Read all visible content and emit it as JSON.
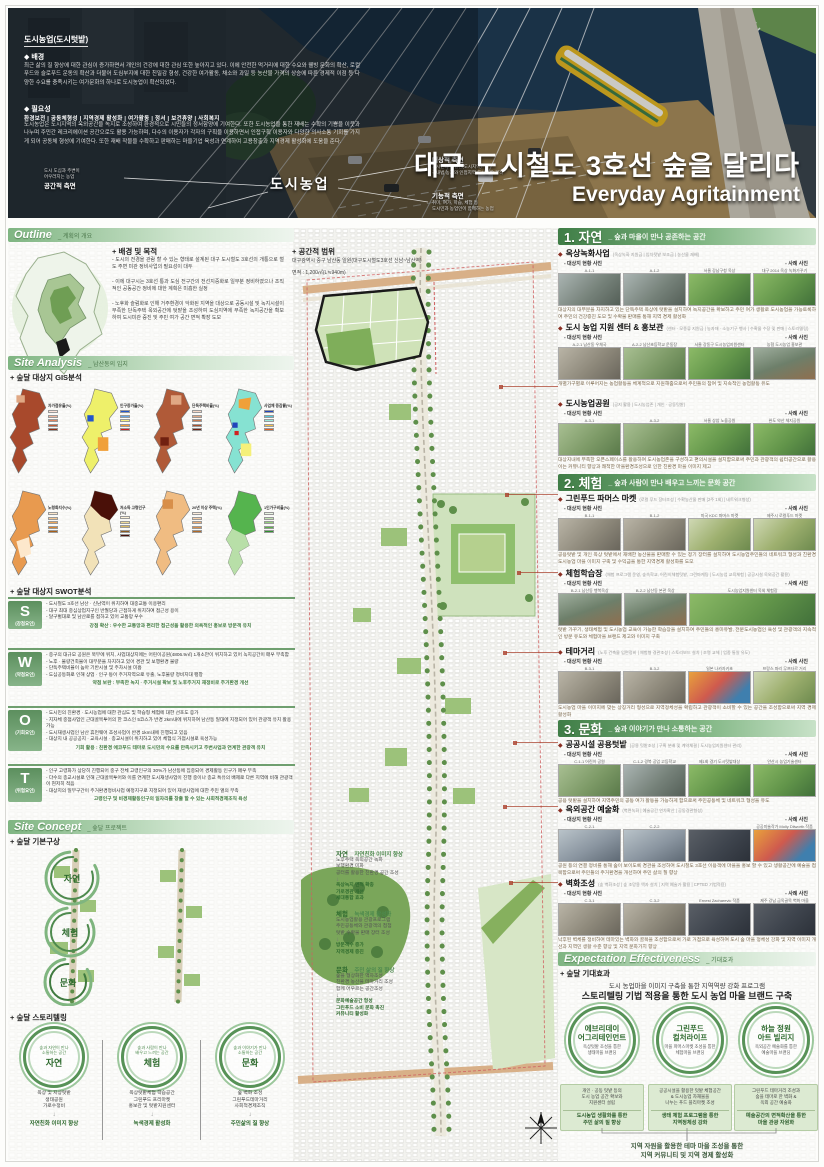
{
  "hero": {
    "topic": "도시농업(도시텃밭)",
    "bg_title": "◆ 배경",
    "bg_text": "최근 삶의 질 향상에 대한 관심이 증가하면서 개인의 건강에 대한 관심 또한 높아지고 있다. 이에 안전한 먹거리에 대한 수요와 웰빙 문화의 확산, 로컬푸드와 슬로푸드 운동의 확산과 더불어 도심부지에 대한 친밀감 형성, 건강한 여가활동, 채소와 과일 등 농산물 가격의 상승에 따른 경제적 이점 등 다양한 수요를 충족시키는 여가문화의 하나로 도시농업이 확산되었다.",
    "need_title": "◆ 필요성",
    "need_keywords": "환경보전  |  공동체형성  |  지역경제 활성화  |  여가활동  |  정서  |  보건휴양  |  사회복지",
    "need_text": "도시농업은 도시지역의 옥외공간을 녹지로 조성하여 환경적으로 시민들의 정서함양에 기여한다. 또한 도시농업을 통한 재배는 수확의 기쁨을 이웃과 나누며 주민간 레크리에이션 공간으로도 활용 가능하며, 다수의 이용자가 각자의 구획을 이용하면서 인접구획 이용자와 다양한 의사소통 기회를 가지게 되어 공동체 형성에 기여한다. 또한 재배 작물을 수확하고 판매하는 마을기업 육성과 연계하여 고용창출과 지역경제 활성화에 도움을 준다.",
    "diagram": {
      "center": "도시농업",
      "left_label": "공간적 측면",
      "left_text": "도시 도심과 주변이\n어우러지는 농업",
      "rt_label": "대상적 측면",
      "rt_text": "도시민과 농업인(도시지역)\n국내법 농지와 인접지역 도시텃밭 경작",
      "rb_label": "기능적 측면",
      "rb_text": "취미, 여가, 학습, 체험 등\n도시민과 농업인이 함께하는 농업"
    },
    "title": "대구 도시철도 3호선 숲을 달리다",
    "subtitle": "Everyday Agritainment"
  },
  "outline": {
    "header": "Outline",
    "header_sub": "_ 계획의 개요",
    "goal_title": "+ 배경 및 목적",
    "goal_text": "- 도시의 전경을 관람 할 수 있는 형태로 설계된 대구 도시철도 3호선의 개통으로 철도 주변 미관 정비사업의 필요성이 대두\n\n- 이에 대구시는 3호선 통과 도심 전구간의 전선지중화로 일부분 정비하였으나 조직적인 공동공간 정비에 대한 계획은 미흡한 실정\n\n- 노후화 슬럼화로 인해 거주환경이 악화된 지역을 대상으로 공동시설 및 녹지시설이 부족한 단독주택 옥외공간에 텃밭을 조성하여 도심지역에 부족한 녹지공간을 확보하여 도시미관 증진 및 주민 여가 공간 면적 확장 도모",
    "scope_title": "+ 공간적 범위",
    "scope_line1": "대구광역시 중구 남산동 일원(대구도시철도3호선 신남~남산역)",
    "scope_line2": "면적 : 1,200㎡(L≒940m)"
  },
  "analysis": {
    "header": "Site Analysis",
    "header_sub": "_ 남산동의 입지",
    "gis_title": "+ 숲달 대상지 GIS분석",
    "gis": [
      {
        "label": "자가점유율(%)"
      },
      {
        "label": "인구증가율(%)"
      },
      {
        "label": "단독주택비율(%)"
      },
      {
        "label": "사업체 증감률(%)"
      },
      {
        "label": "노령화지수(%)"
      },
      {
        "label": "저소득 고령인구(%)"
      },
      {
        "label": "20년 이상 주택(%)"
      },
      {
        "label": "1인가구비율(%)"
      }
    ],
    "swot_title": "+ 숲달 대상지 SWOT분석",
    "swot": [
      {
        "letter": "S",
        "name": "(강점요인)",
        "items": "- 도시철도 3호선 남산 · 신남역이 위치하여 대중교통 이용편리\n- 대구 최대 중심상업지구인 반월당과 근접하게 위치하여 접근성 용이\n- 달구벌대로 및 남산로를 접하고 있어 교통망 우수",
        "summary": "강점 확산 : 우수한 교통망과 편리한 접근성을 활용한 의욕적인 홍보로 방문객 유치"
      },
      {
        "letter": "W",
        "name": "(약점요인)",
        "items": "- 중구의 대규모 공원은 북부에 위치, 사업대상지에는 어린이공원(4806.9㎡) 1개소만이 위치하고 있어 녹지공간이 매우 부족함\n- 노후 · 불량건축물이 대부분을 차지하고 있어 경관 및 보행환경 불량\n- 단독주택비율이 높아 기반시설 및 주차시설 미흡\n- 도심공동화로 인해 상업 · 인구 등이 주거지역으로 유출, 노후불량 정비지대 팽창",
        "summary": "약점 보완 : 부족한 녹지 · 주거시설 확보 및 노후주거지 재정비로 주거환경 개선"
      },
      {
        "letter": "O",
        "name": "(기회요인)",
        "items": "- 도시민의 친환경 · 도시농업에 대한 관심도 및 학습형 체험에 대한 선호도 증가\n- 지자체 중점사업인 근대골목투어의 한 코스인 5코스가 반경 2km내에 위치하여 남산동 일대에 지정되어 있어 관광객 유치 활용가능\n- 도시재생사업인 남산 휴먼웨어 조성사업이 반경 1km내에 진행되고 있음\n- 대상지 내 공공공지 · 교육시설 · 종교시설이 위치하고 있어 체험식 거점시설로 육성가능",
        "summary": "기회 활용 : 친환경 에코푸드 테마로 도시민의 수요를 만족시키고 주변사업과 연계한 관광객 유치"
      },
      {
        "letter": "T",
        "name": "(위협요인)",
        "items": "- 인구 고령화가 상당히 진행되어 중구 전체 고령인구의 30%가 남산동에 집중되어 경제활동 인구가 매우 부족\n- 다수의 종교시설로 인해 근대골목투어와 이를 연계한 도시재생사업이 진행 중이나 종교 특유의 배제로 다른 지역에 비해 관광객이 현저히 적음\n- 대상지의 일부구간이 주거환경정비사업 예정지구로 지정되어 있어 재생사업에 대한 주민 열의 부족",
        "summary": "고령인구 및 비경제활동인구의 일자리를 창출 할 수 있는 사회적경제조직 육성"
      }
    ]
  },
  "concept": {
    "header": "Site Concept",
    "header_sub": "_ 숲달 프로젝트",
    "title": "+ 숲달 기본구상",
    "themes": [
      {
        "name": "자연",
        "tagline": "_ 자연친화 이미지 향상",
        "inputs": "노후주택 옥외공간 녹화\n보행환경 미화\n공터를 활용한 친환경 공간 조성",
        "outputs": "옥상녹지 면적 확충\n가로경관 개선\n세대통합 효과"
      },
      {
        "name": "체험",
        "tagline": "_ 녹색경제 활성화",
        "inputs": "도시농업활용 관광프로그램\n주민공동체와 관광객의 접점\n텃밭 수확물 판매 장터 조성",
        "outputs": "방문객수 증가\n지역경제 증진"
      },
      {
        "name": "문화",
        "tagline": "_ 주민 삶의 질 향상",
        "inputs": "숲을 형상화한 액자조성\n친환경 농산물 테마거리 조성\n함께 어우르는 공간조성",
        "outputs": "문화예술공간 형성\n그린푸드 소비 문화 촉진\n커뮤니티 활성화"
      }
    ],
    "story_title": "+ 숲달 스토리텔링",
    "stories": [
      {
        "name": "자연",
        "circle_text": "숲과 자연이 만나\n소통하는 공간",
        "items": "옥상 및 지상텃밭\n생태공원\n가로수정비",
        "result": "자연친화 이미지 향상"
      },
      {
        "name": "체험",
        "circle_text": "숲과 사람이 만나\n배우고 느끼는 공간",
        "items": "옥상텃밭체험 학습공간\n그린푸드 프리마켓\n홍보관 및 텃밭지원센터",
        "result": "녹색경제 활성화"
      },
      {
        "name": "문화",
        "circle_text": "숲과 이야기가 만나\n소통하는 공간",
        "items": "숲 벽화 조성\n그린푸드테마거리\n사회적경제조직",
        "result": "주민삶의 질 향상"
      }
    ]
  },
  "labels": {
    "site": "- 대상지 현황 사진",
    "case": "- 사례 사진"
  },
  "right": {
    "sections": [
      {
        "number": "1.",
        "name": "자연",
        "tagline": "_ 숲과 마을이 만나 공존하는 공간",
        "items": [
          {
            "title": "옥상녹화사업",
            "tags": "(옥상녹화 지원금 | 임차텃밭 보조금 | 농산물 재배)",
            "photos": [
              "A-1-1",
              "A-1-2",
              "서울 강남구청 옥상",
              "대구 2014 옥상 녹화가꾸기"
            ],
            "desc": "대상지의 대부분을 차지하고 있는 단독주택 옥상에 텃밭을 설치하여 녹지공간을 확보하고 주민 여가 생활로 도시농업을 가능토록하여 주민의 건강증진 도모 및 수확물 판매를 통해 지역 경제 활성화"
          },
          {
            "title": "도시 농업 지원 센터 & 홍보관",
            "tags": "(센터 · 모종류 지원금 | 농자재 · 소농기구 행사 | 수확물 수장 및 판매 | 스토리텔링)",
            "photos": [
              "A-2-1 남산동 우체국",
              "A-2-2 남산초등학교 운동장",
              "서울 강동구 도시농업지원센터",
              "농협 도시농업 홍보관"
            ],
            "desc": "개별가구별로 이루어지는 농업활동을 체계적으로 지원해줌으로써 주민들의 참여 및 지속적인 농업활동 유도"
          },
          {
            "title": "도시농업공원",
            "tags": "(공지 활용 | 도시농업존 | 개인 · 공동텃밭)",
            "photos": [
              "A-3-1",
              "A-3-2",
              "서울 상암 노을공원",
              "완도 약산 체지공원"
            ],
            "desc": "대상지내에 부족한 오픈스페이스를 활용하여 도시농업존을 구성하고 편의시설을 설치함으로써 주민과 관광객의 쉼터공간으로 활용 이는 커뮤니티 향상과 쾌적한 마을환경조성으로 인한 친환경 마을 이미지 제고"
          }
        ]
      },
      {
        "number": "2.",
        "name": "체험",
        "tagline": "_ 숲과 사람이 만나 배우고 느끼는 문화 공간",
        "items": [
          {
            "title": "그린푸드 파머스 마켓",
            "tags": "(로컬 푸드 장터조성 | 수확농산물 판매 (2주 1회) | 네트워크형성)",
            "photos": [
              "B-1-1",
              "B-1-2",
              "미국 KDC 파머스 마켓",
              "제주시 로컬푸드 마켓"
            ],
            "desc": "공용텃밭 및 개인 옥상 텃밭에서 재배한 농산물을 판매할 수 있는 정기 장터를 설치하여 도시농업주민들의 네트워크 형성과 친환경 도시농업 마을 이미지 구축 및 수익금을 통한 지역경제 활성화를 도모"
          },
          {
            "title": "체험학습장",
            "tags": "(체험 프로그램 운영, 숲속학교, 어린이체험텃밭, 그린마케팅 | 도시농업 교육체험 | 공공시설 옥외공간 활용)",
            "photos": [
              "B-2-1 남산동 행복옥상",
              "B-2-2 남산동 본관 옥상",
              "도시농업지원센터 옥외 체험장"
            ],
            "desc": "텃밭 가꾸기, 생태체험 및 도시농업 교육이 가능한 학습장을 설치하여 주민들의 흥미유발, 전문도시농업인 육성 및 관광객의 지속적인 방문 유도와 체험마을 브랜드 제고와 이미지 구축"
          },
          {
            "title": "테마거리",
            "tags": "(노후 건축물 입면정비 | 체험형 경관조성 | 스토리보드 설치 | 조명 교체 | 업종 통일 유도)",
            "photos": [
              "B-3-1",
              "B-3-2",
              "일본 나카자키초",
              "프랑스 파리 무프타르 거리"
            ],
            "desc": "도시농업 마을 이미지에 맞는 상징거리 형성으로 지역정체성을 확립하고 관광객이 소비할 수 있는 공간을 조성함으로써 지역 경제 활성화"
          }
        ]
      },
      {
        "number": "3.",
        "name": "문화",
        "tagline": "_ 숲과 이야기가 만나 소통하는 공간",
        "items": [
          {
            "title": "공공시설 공용텃밭",
            "tags": "(공용 텃밭조성 | 구획 분배 및 계약체결 | 도시농업지원센터 관리)",
            "photos": [
              "C-1-1 어린이 공원",
              "C-1-2 경북 공업 고등학교",
              "제1회 경기 도시텃밭대상",
              "안산시 농업기술센터"
            ],
            "desc": "공용 텃밭을 설치하여 지역주민의 공동 여가 활동을 가능하게 함으로써 주민공동체 및 네트워크 형성을 유도"
          },
          {
            "title": "옥외공간 예술화",
            "tags": "(벽면녹화 | 예술공간 연차확산 | 공동경관형성)",
            "photos": [
              "C-2-1",
              "C-2-2",
              "",
              "공공미술작가 Molly Dilworth 작품"
            ],
            "desc": "공원 등의 연결 정비를 통해 숲이 보이도록 경관을 조성하여 도시철도 3호선 이용객에 마을을 홍보 할 수 있고 생활공간에 예술을 접목함으로써 주민들의 주거환경을 개선하여 주민 삶의 질 향상"
          },
          {
            "title": "벽화조성",
            "tags": "(숲 벽화조성 | 숲 조망용 액자 설치 | 지역 예술가 활용 | CPTED 기법적용)",
            "photos": [
              "C-3-1",
              "C-3-2",
              "Ernest Zacharevic 작품",
              "제주 강남 금옥골목 벽화 마을"
            ],
            "desc": "낙후된 벽체를 정비하여 테마있는 벽화와 골목을 조성함으로써 가로 거점으로 육성하여 도시 숲 마을 정체성 강화 및 지역 이미지 개선과 지역민 생활 수준 향상 및 지역 문화가치 향상"
          }
        ]
      }
    ]
  },
  "expectation": {
    "header": "Expectation Effectiveness",
    "header_sub": "_ 기대효과",
    "title": "+ 숲달 기대효과",
    "line1": "도시 농업마을 이미지 구축을 통한 지역역량 강화 프로그램",
    "line2": "스토리텔링 기법 적용을 통한 도시 농업 마을 브랜드 구축",
    "brands": [
      {
        "name": "에브리데이\n어그리테인먼트",
        "sub": "옥상텃밭 조성을 통한\n생태마을 브랜딩",
        "box": "개인 · 공동 텃밭 등의\n도시 농업 공간 확보와\n지원센터 설립",
        "result": "도시농업 생활화를 통한\n주민 삶의 질 향상"
      },
      {
        "name": "그린푸드\n컬처라이프",
        "sub": "마을 파머스마켓 조성을 통한\n체험마을 브랜딩",
        "box": "공공시설을 활용한 텃밭 체험공간\n& 도시농업 자재물을\n나누는 푸드 플리마켓 조성",
        "result": "생태 체험 프로그램을 통한\n지역정체성 강화"
      },
      {
        "name": "하늘 정원\n아트 빌리지",
        "sub": "옥외공간 예술화를 통한\n예술마을 브랜딩",
        "box": "그린푸드 테마거리 조성과\n숲을 테마로 한 벽화 &\n옥외 공간 예술화",
        "result": "예술공간의 면적확산을 통한\n마을 관광 자원화"
      }
    ],
    "footer": "지역 자원을 활용한 테마 마을 조성을 통한\n지역 커뮤니티 및 지역 경제 활성화"
  }
}
